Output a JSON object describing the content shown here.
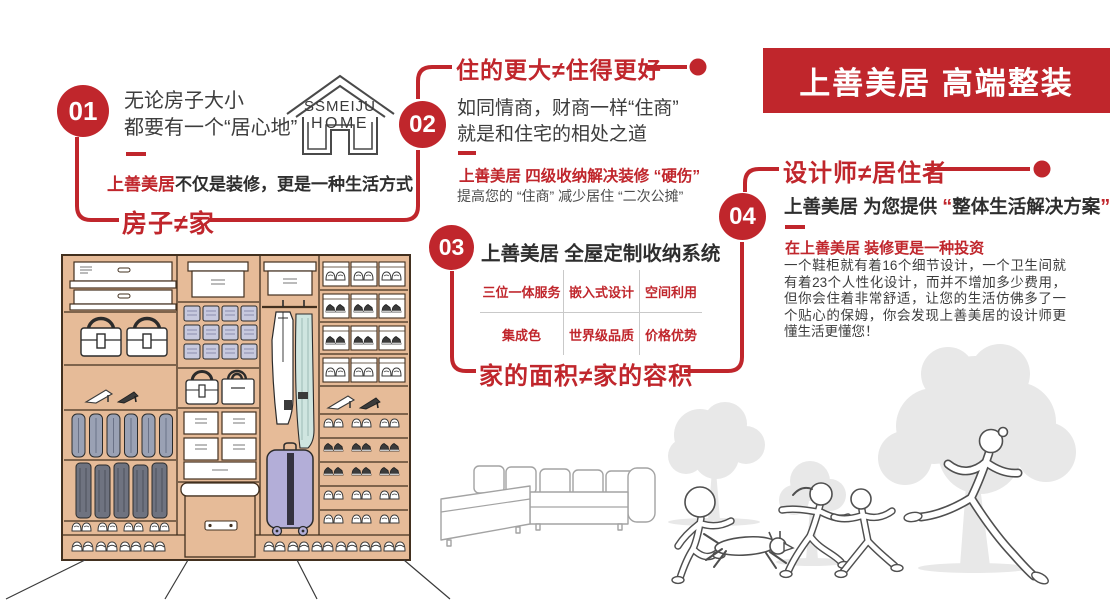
{
  "palette": {
    "accent": "#c0262c",
    "banner_bg": "#c0262c",
    "wardrobe_tan": "#e6bb98",
    "suitcase_purple": "#b3aed8",
    "bins_lavender": "#c7c9de",
    "tree_gray": "#e8e8e8"
  },
  "banner": {
    "title": "上善美居 高端整装"
  },
  "logo": {
    "line1": "SSMEIJU",
    "line2": "HOME"
  },
  "sections": {
    "s01": {
      "number": "01",
      "intro_line1": "无论房子大小",
      "intro_line2": "都要有一个“居心地”",
      "slogan_highlight": "上善美居",
      "slogan_rest": "不仅是装修，更是一种生活方式",
      "keyword": "房子≠家"
    },
    "s02": {
      "number": "02",
      "title": "住的更大≠住得更好",
      "body_line1": "如同情商，财商一样“住商”",
      "body_line2": "就是和住宅的相处之道",
      "highlight": "上善美居 四级收纳解决装修 “硬伤”",
      "subtext": "提高您的 “住商” 减少居住 “二次公摊”"
    },
    "s03": {
      "number": "03",
      "title": "上善美居 全屋定制收纳系统",
      "grid": [
        [
          "三位一体服务",
          "嵌入式设计",
          "空间利用"
        ],
        [
          "集成色",
          "世界级品质",
          "价格优势"
        ]
      ],
      "keyword": "家的面积≠家的容积"
    },
    "s04": {
      "number": "04",
      "title": "设计师≠居住者",
      "subtitle_prefix": "上善美居 为您提供 ",
      "quote_open": "“",
      "subtitle_quoted": "整体生活解决方案",
      "quote_close": "”",
      "highlight": "在上善美居 装修更是一种投资",
      "paragraph": "一个鞋柜就有着16个细节设计，一个卫生间就有着23个人性化设计，而并不增加多少费用，但你会住着非常舒适，让您的生活仿佛多了一个贴心的保姆，你会发现上善美居的设计师更懂生活更懂您！"
    }
  },
  "illustrations": {
    "wardrobe": "wardrobe-storage-illustration",
    "sofa": "sectional-sofa-illustration",
    "family": "family-running-illustration",
    "trees": "trees-silhouette-illustration"
  }
}
